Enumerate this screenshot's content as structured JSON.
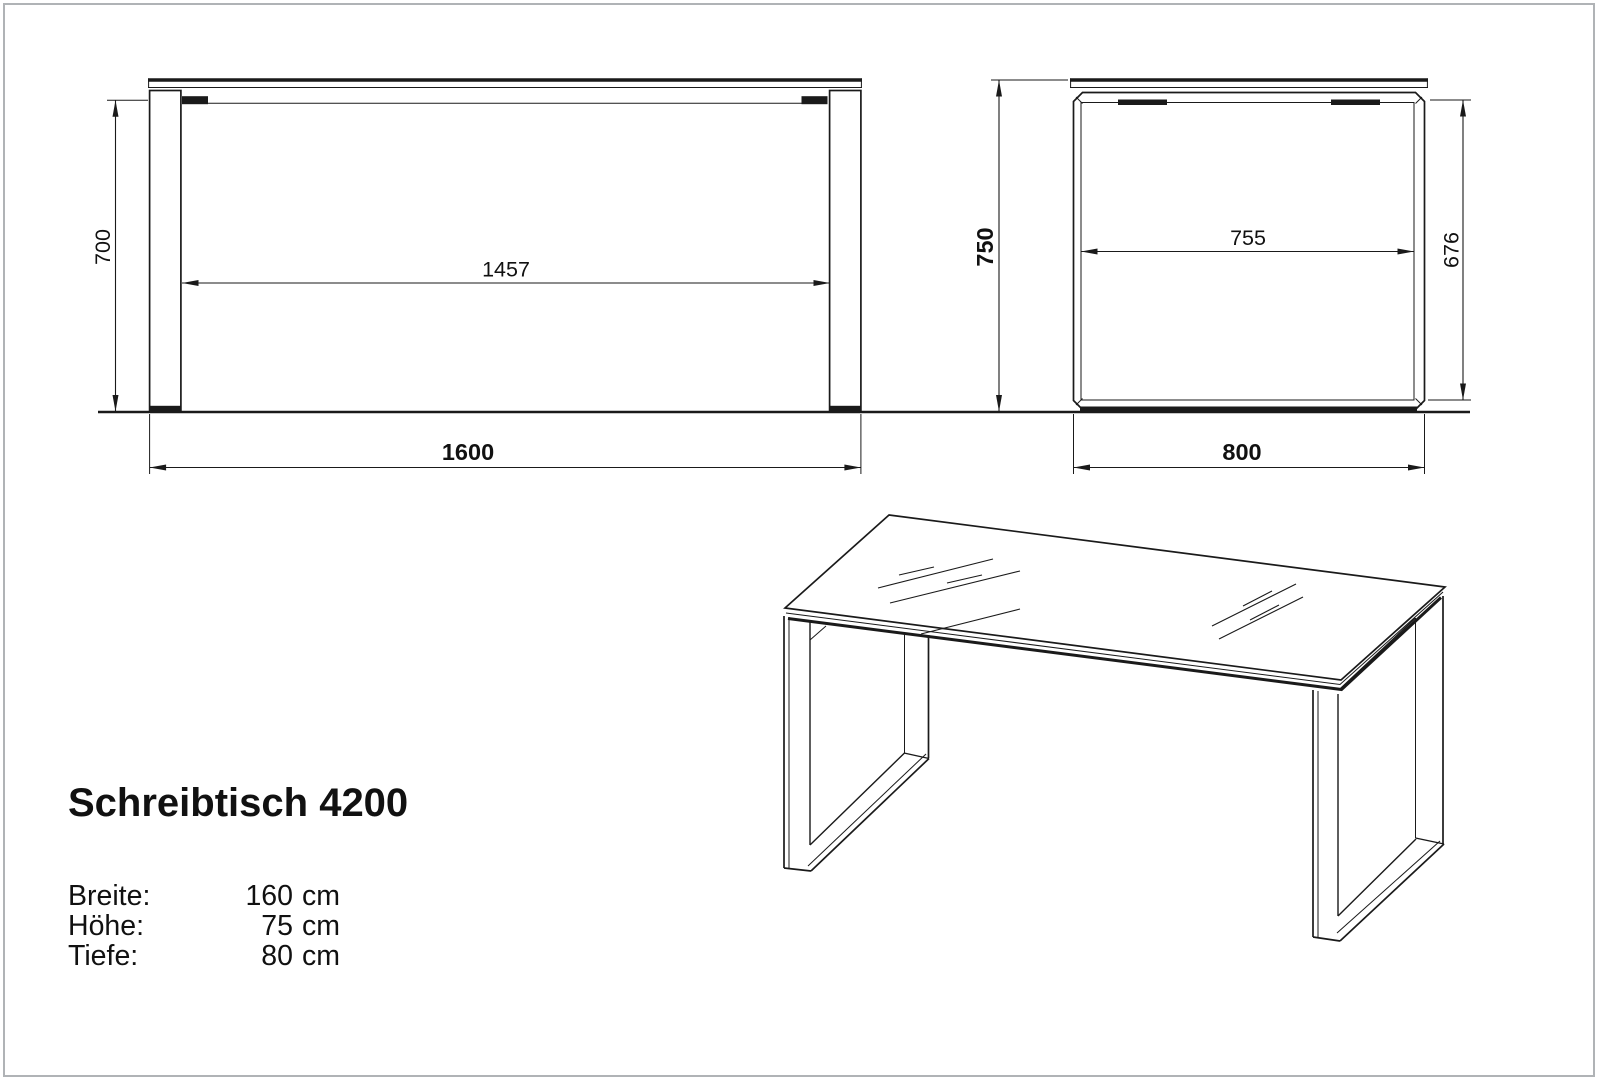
{
  "drawing": {
    "line_color": "#1a1a1a",
    "border_color": "#b0b3b6",
    "front_view": {
      "dim_leg_height": "700",
      "dim_inner_width": "1457",
      "dim_total_width": "1600"
    },
    "side_view": {
      "dim_total_height": "750",
      "dim_inner_depth": "755",
      "dim_inner_height": "676",
      "dim_total_depth": "800"
    },
    "info_block": {
      "title": "Schreibtisch 4200",
      "specs": [
        {
          "label": "Breite:",
          "value": "160",
          "unit": "cm"
        },
        {
          "label": "Höhe:",
          "value": "75",
          "unit": "cm"
        },
        {
          "label": "Tiefe:",
          "value": "80",
          "unit": "cm"
        }
      ]
    }
  }
}
